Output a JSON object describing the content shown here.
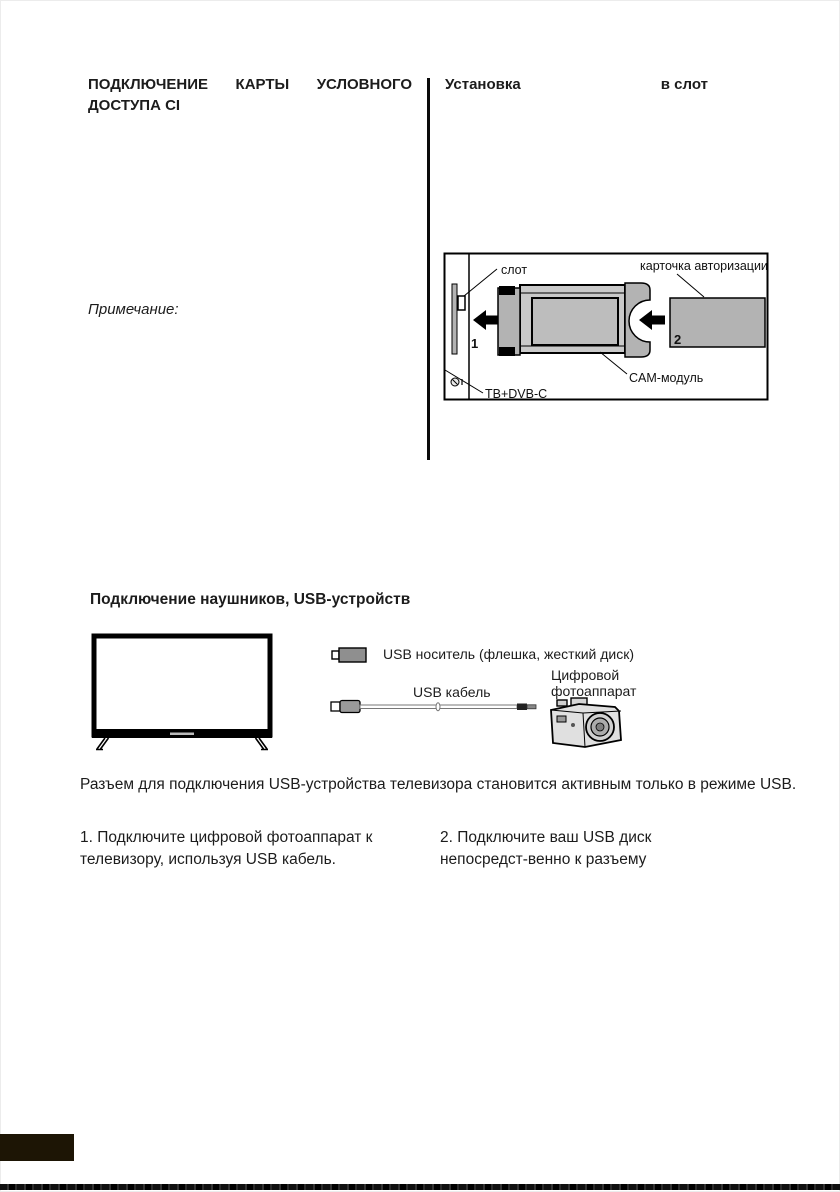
{
  "ci_section": {
    "heading_line1": "ПОДКЛЮЧЕНИЕ КАРТЫ УСЛОВНОГО",
    "heading_line2": "ДОСТУПА CI",
    "note_label": "Примечание:"
  },
  "install_section": {
    "heading_word1": "Установка",
    "heading_word2": "в слот",
    "diagram": {
      "slot_label": "слот",
      "card_label": "карточка авторизации",
      "cam_label": "CAM-модуль",
      "tv_label": "ТВ+DVB-C",
      "step1": "1",
      "step2": "2"
    }
  },
  "usb_section": {
    "heading": "Подключение наушников, USB-устройств",
    "usb_drive_label": "USB носитель (флешка, жесткий диск)",
    "usb_cable_label": "USB кабель",
    "camera_label_line1": "Цифровой",
    "camera_label_line2": "фотоаппарат",
    "paragraph": "Разъем для подключения USB-устройства телевизора становится активным только в режиме USB.",
    "step1": "1. Подключите цифровой фотоаппарат к телевизору, используя USB кабель.",
    "step2": "2. Подключите ваш USB диск непосредст-венно к разъему"
  },
  "colors": {
    "text": "#1c1c1c",
    "diagram_gray": "#b3b3b3",
    "badge": "#1d1505"
  }
}
